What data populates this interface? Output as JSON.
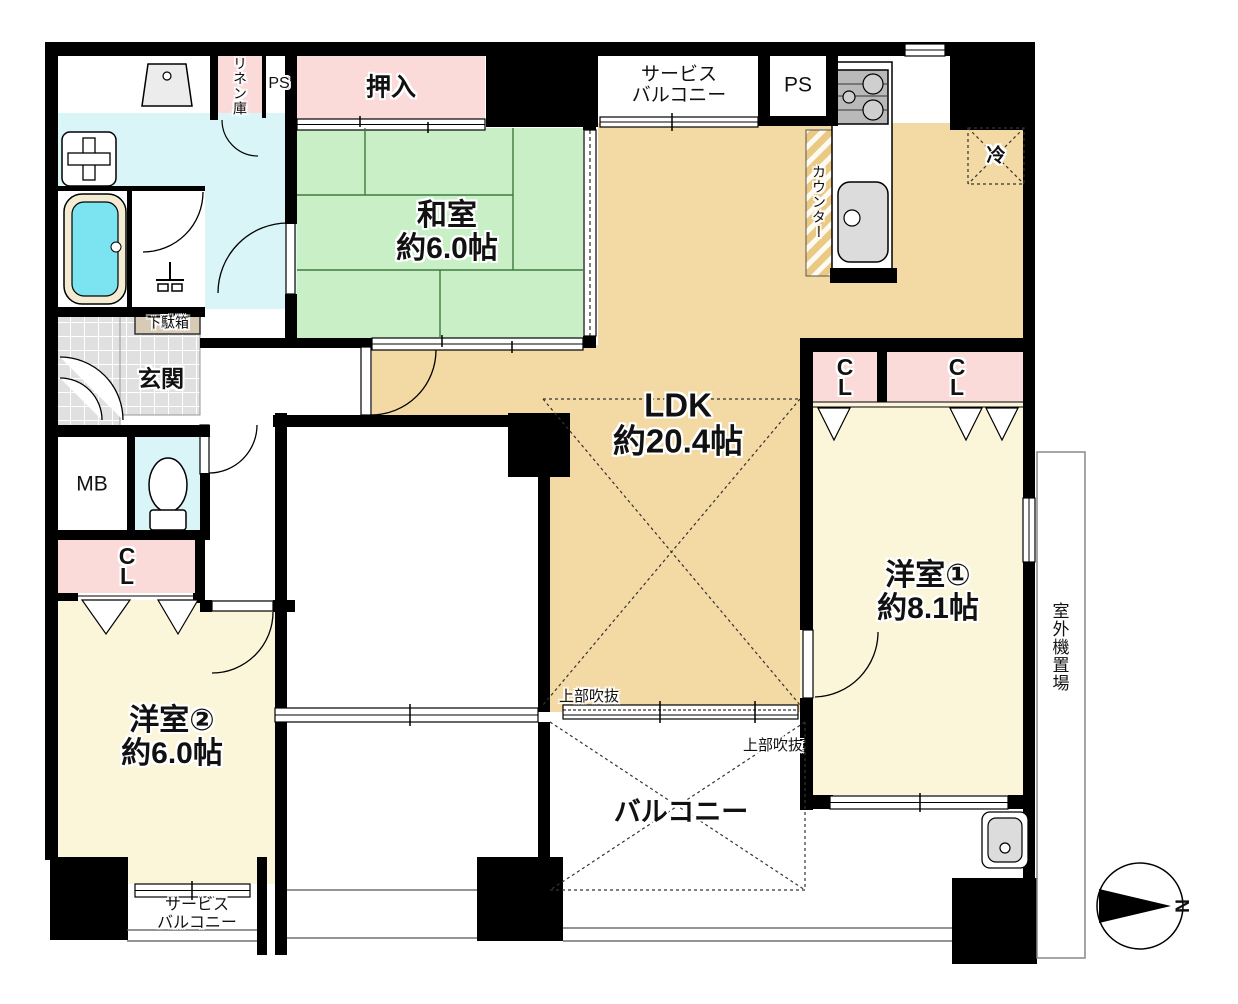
{
  "plan": {
    "title": "apartment-floor-plan",
    "rooms": {
      "washitsu": {
        "name": "和室",
        "size": "約6.0帖"
      },
      "ldk": {
        "name": "LDK",
        "size": "約20.4帖"
      },
      "western1": {
        "name": "洋室①",
        "size": "約8.1帖"
      },
      "western2": {
        "name": "洋室②",
        "size": "約6.0帖"
      },
      "balcony": {
        "name": "バルコニー"
      },
      "service_balcony_top": {
        "line1": "サービス",
        "line2": "バルコニー"
      },
      "service_balcony_bottom": {
        "line1": "サービス",
        "line2": "バルコニー"
      },
      "genkan": {
        "name": "玄関"
      },
      "oshiire": {
        "name": "押入"
      },
      "linen_closet": {
        "name": "リネン庫"
      },
      "ps_left": {
        "name": "PS"
      },
      "ps_right": {
        "name": "PS"
      },
      "meter_box": {
        "name": "MB"
      },
      "shoe_cabinet": {
        "name": "下駄箱"
      },
      "counter": {
        "name": "カウンター"
      },
      "refrigerator": {
        "name": "冷"
      },
      "outdoor_unit": {
        "name": "室外機置場"
      },
      "open_above_left": {
        "name": "上部吹抜"
      },
      "open_above_right": {
        "name": "上部吹抜"
      },
      "closet_hall": {
        "line1": "C",
        "line2": "L"
      },
      "closet_w1_left": {
        "line1": "C",
        "line2": "L"
      },
      "closet_w1_right": {
        "line1": "C",
        "line2": "L"
      }
    },
    "compass": {
      "north": "N"
    },
    "colors": {
      "wall": "#000000",
      "ldk_floor": "#f3d9a3",
      "tatami_green": "#c9efc7",
      "cream_room": "#fbf5da",
      "closet_pink": "#fbdada",
      "water_aqua": "#d9f5f7",
      "bathtub_cyan": "#7ce4f0",
      "tile_gray": "#e0e0e0",
      "counter_tan": "#eac983",
      "shoe_tan": "#d8cbb6",
      "fixture_gray": "#dcdcdc",
      "stove_gray": "#b9b9b9"
    }
  }
}
